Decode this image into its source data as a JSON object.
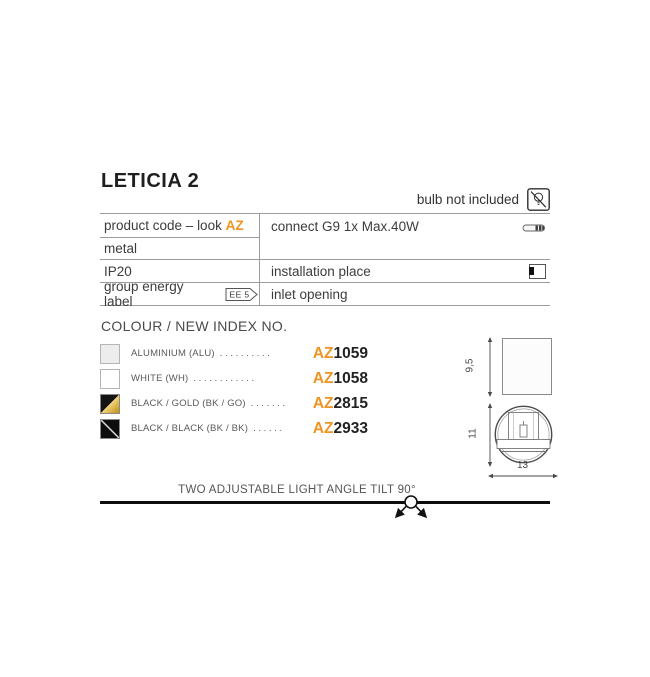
{
  "header": {
    "title": "LETICIA 2",
    "bulb_note": "bulb not included"
  },
  "spec_table": {
    "product_code_label": "product code – look ",
    "product_code_accent": "AZ",
    "connect": "connect G9 1x Max.40W",
    "material": "metal",
    "ip_rating": "IP20",
    "installation_place": "installation place",
    "energy_label": "group energy label",
    "energy_badge": "EE 5",
    "inlet": "inlet opening"
  },
  "colours": {
    "heading": "COLOUR / NEW INDEX NO.",
    "code_prefix": "AZ",
    "items": [
      {
        "label": "ALUMINIUM (ALU)",
        "dots": ". . . . . . . . . .",
        "code": "1059",
        "swatch": "aluminium"
      },
      {
        "label": "WHITE (WH)",
        "dots": ". . . . . . . . . . . .",
        "code": "1058",
        "swatch": "white"
      },
      {
        "label": "BLACK / GOLD (BK / GO)",
        "dots": ". . . . . . .",
        "code": "2815",
        "swatch": "black-gold"
      },
      {
        "label": "BLACK / BLACK (BK / BK)",
        "dots": ". . . . . .",
        "code": "2933",
        "swatch": "black-black"
      }
    ]
  },
  "dimensions": {
    "front_height": "9,5",
    "side_height": "11",
    "side_width": "13"
  },
  "footer": {
    "note": "TWO ADJUSTABLE LIGHT ANGLE TILT 90°"
  },
  "colors": {
    "accent": "#F09320",
    "text_dark": "#2E2E2E",
    "text_gray": "#555555",
    "table_border": "#9B9B9B",
    "gold": "#C9992B"
  }
}
